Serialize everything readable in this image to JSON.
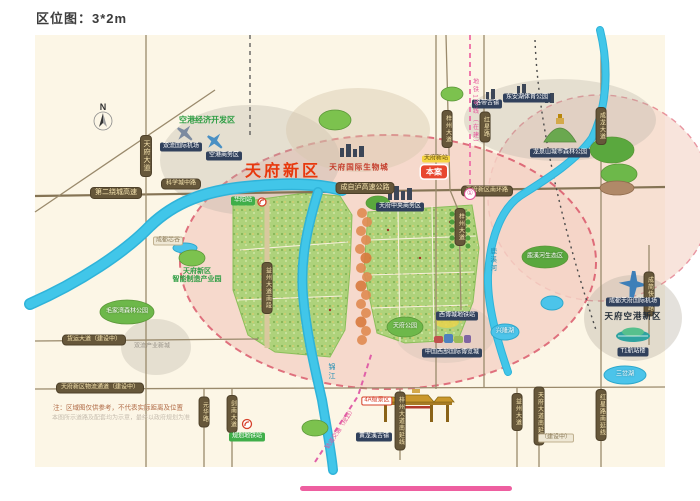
{
  "title": "区位图：3*2m",
  "colors": {
    "map_bg": "#fcf6e6",
    "district_pink": "#f5d3c6",
    "boundary_red": "#d94f63",
    "river_blue": "#41c6e9",
    "green_area": "#aed27b",
    "accent_red": "#e8380d",
    "road_band_bg": "#66573a",
    "badge_navy": "#31415c",
    "metro_pink": "#e4559a"
  },
  "map": {
    "labels": [
      {
        "t": "第二绕城高速",
        "x": 116,
        "y": 193,
        "c": "band",
        "n": "road-band-second-ring-expressway"
      },
      {
        "t": "科学城中路",
        "x": 181,
        "y": 184,
        "c": "band sm",
        "n": "road-band-science-city-road"
      },
      {
        "t": "成自泸高速公路",
        "x": 365,
        "y": 188,
        "c": "band",
        "n": "road-band-chengzilu-expressway"
      },
      {
        "t": "天府新区南环路",
        "x": 487,
        "y": 191,
        "c": "band sm",
        "n": "road-band-south-ring"
      },
      {
        "t": "货运大道（建设中）",
        "x": 94,
        "y": 340,
        "c": "band sm",
        "n": "road-band-freight-avenue"
      },
      {
        "t": "天府新区物流通道（建设中）",
        "x": 100,
        "y": 388,
        "c": "band sm",
        "n": "road-band-logistics-channel"
      },
      {
        "t": "天府大道",
        "x": 146,
        "y": 156,
        "c": "band v",
        "n": "road-band-tianfu-avenue"
      },
      {
        "t": "益州大道南段",
        "x": 267,
        "y": 288,
        "c": "band v sm",
        "n": "road-band-yizhou-south"
      },
      {
        "t": "梓州大道",
        "x": 447,
        "y": 129,
        "c": "band v sm",
        "n": "road-band-zizhou-avenue-n"
      },
      {
        "t": "红星路",
        "x": 485,
        "y": 127,
        "c": "band v sm",
        "n": "road-band-hongxing-road"
      },
      {
        "t": "梓州大道",
        "x": 460,
        "y": 227,
        "c": "band v sm",
        "n": "road-band-zizhou-avenue"
      },
      {
        "t": "成龙大道",
        "x": 601,
        "y": 126,
        "c": "band v sm",
        "n": "road-band-chenglong-avenue"
      },
      {
        "t": "成简快速路",
        "x": 649,
        "y": 294,
        "c": "band v sm",
        "n": "road-band-chengjian-expressway"
      },
      {
        "t": "益州大道",
        "x": 517,
        "y": 412,
        "c": "band v sm",
        "n": "road-band-yizhou-avenue"
      },
      {
        "t": "天府大道南延线",
        "x": 539,
        "y": 416,
        "c": "band v sm",
        "n": "road-band-tianfu-south-ext"
      },
      {
        "t": "红星路南延线",
        "x": 601,
        "y": 415,
        "c": "band v sm",
        "n": "road-band-hongxing-south-ext"
      },
      {
        "t": "梓州大道南延线",
        "x": 400,
        "y": 421,
        "c": "band v sm",
        "n": "road-band-zizhou-south-ext"
      },
      {
        "t": "元华路",
        "x": 204,
        "y": 412,
        "c": "band v sm",
        "n": "road-band-yuanhua-road"
      },
      {
        "t": "剑南大道",
        "x": 232,
        "y": 414,
        "c": "band v sm",
        "n": "road-band-jiannan-avenue"
      },
      {
        "t": "双流国际机场",
        "x": 181,
        "y": 147,
        "c": "navy",
        "n": "badge-shuangliu-airport"
      },
      {
        "t": "空港商务区",
        "x": 224,
        "y": 156,
        "c": "navy",
        "n": "badge-airport-business-zone"
      },
      {
        "t": "天府中央商务区",
        "x": 400,
        "y": 207,
        "c": "navy",
        "n": "badge-tianfu-cbd"
      },
      {
        "t": "西博城地铁站",
        "x": 457,
        "y": 316,
        "c": "navy",
        "n": "badge-expo-metro-station"
      },
      {
        "t": "中国西部国际博览城",
        "x": 452,
        "y": 353,
        "c": "navy",
        "n": "badge-western-expo-city"
      },
      {
        "t": "黄龙溪古镇",
        "x": 374,
        "y": 437,
        "c": "navy",
        "n": "badge-huanglongxi-town"
      },
      {
        "t": "成都天府国际机场",
        "x": 633,
        "y": 302,
        "c": "navy",
        "n": "badge-tianfu-intl-airport"
      },
      {
        "t": "东安湖体育公园",
        "x": 527,
        "y": 98,
        "c": "navy",
        "n": "badge-donganhu-park"
      },
      {
        "t": "龙泉山城市森林公园",
        "x": 560,
        "y": 153,
        "c": "navy",
        "n": "badge-longquanshan-park"
      },
      {
        "t": "洛带古镇",
        "x": 487,
        "y": 104,
        "c": "navy",
        "n": "badge-luodai-town"
      },
      {
        "t": "T1航站楼",
        "x": 633,
        "y": 352,
        "c": "navy",
        "n": "badge-terminal-t1"
      },
      {
        "t": "天府新站",
        "x": 436,
        "y": 159,
        "c": "gold-b",
        "n": "badge-tianfu-new-station"
      },
      {
        "t": "本案",
        "x": 434,
        "y": 172,
        "c": "red-b",
        "n": "project-marker"
      },
      {
        "t": "规划地铁站",
        "x": 247,
        "y": 437,
        "c": "green-b",
        "n": "badge-planned-metro-station"
      },
      {
        "t": "华阳站",
        "x": 243,
        "y": 201,
        "c": "green-b",
        "n": "badge-huayang-station"
      },
      {
        "t": "4A级景区",
        "x": 377,
        "y": 401,
        "c": "white-b",
        "n": "badge-4a-scenic"
      },
      {
        "t": "成都芯谷",
        "x": 168,
        "y": 241,
        "c": "gray-b",
        "n": "badge-chengdu-chip-valley"
      },
      {
        "t": "（建设中）",
        "x": 556,
        "y": 438,
        "c": "gray-b",
        "n": "badge-under-construction"
      },
      {
        "t": "双流产业新城",
        "x": 152,
        "y": 347,
        "c": "t-gray",
        "n": "label-industry-town"
      },
      {
        "t": "天府新区",
        "x": 283,
        "y": 172,
        "c": "t-red-big",
        "n": "district-label-tianfu-new-area"
      },
      {
        "t": "空港经济开发区",
        "x": 207,
        "y": 120,
        "c": "t-green",
        "fs": 8,
        "n": "label-airport-economic-zone"
      },
      {
        "t": "天府国际生物城",
        "x": 359,
        "y": 168,
        "c": "t-red",
        "n": "label-tianfu-bio-city"
      },
      {
        "t": "天府新区\n智能制造产业园",
        "x": 197,
        "y": 276,
        "c": "t-green ml",
        "n": "label-intelligent-manufacturing-park"
      },
      {
        "t": "天府空港新区",
        "x": 633,
        "y": 317,
        "c": "t-dark",
        "n": "label-tianfu-airport-new-area"
      },
      {
        "t": "兴隆湖",
        "x": 505,
        "y": 332,
        "c": "t-white",
        "n": "label-xinglong-lake"
      },
      {
        "t": "三岔湖",
        "x": 625,
        "y": 375,
        "c": "t-white",
        "n": "label-sancha-lake"
      },
      {
        "t": "鹿溪河生态区",
        "x": 545,
        "y": 257,
        "c": "t-white",
        "n": "label-luxi-river-eco-zone"
      },
      {
        "t": "天府公园",
        "x": 405,
        "y": 327,
        "c": "t-white",
        "n": "label-tianfu-park"
      },
      {
        "t": "毛家湾森林公园",
        "x": 127,
        "y": 312,
        "c": "t-white",
        "n": "label-maojiawan-forest-park"
      },
      {
        "t": "锦江",
        "x": 331,
        "y": 372,
        "c": "t-blue v2",
        "n": "label-jinjiang-river"
      },
      {
        "t": "鹿溪河",
        "x": 492,
        "y": 260,
        "c": "t-blue v2",
        "fs": 6.5,
        "n": "label-luxi-river"
      },
      {
        "t": "地铁1号线（在建）",
        "x": 474,
        "y": 113,
        "c": "t-pink v2",
        "n": "label-metro-line1"
      },
      {
        "t": "轨道交通（规划）",
        "x": 341,
        "y": 429,
        "c": "t-pink",
        "r": -57,
        "n": "label-planned-rail"
      },
      {
        "t": "注：区域图仅供参考，不代表实际距离及位置",
        "x": 118,
        "y": 408,
        "c": "note1",
        "n": "map-disclaimer"
      },
      {
        "t": "本图所示道路及配套均为示意，最终以政府规划为准",
        "x": 121,
        "y": 419,
        "c": "note2",
        "n": "map-disclaimer-fine"
      },
      {
        "t": "①",
        "x": 470,
        "y": 194,
        "c": "metro1",
        "n": "metro-line1-station-dot"
      },
      {
        "t": "N",
        "x": 103,
        "y": 107,
        "c": "t-compass",
        "n": "compass-n-label"
      }
    ]
  }
}
